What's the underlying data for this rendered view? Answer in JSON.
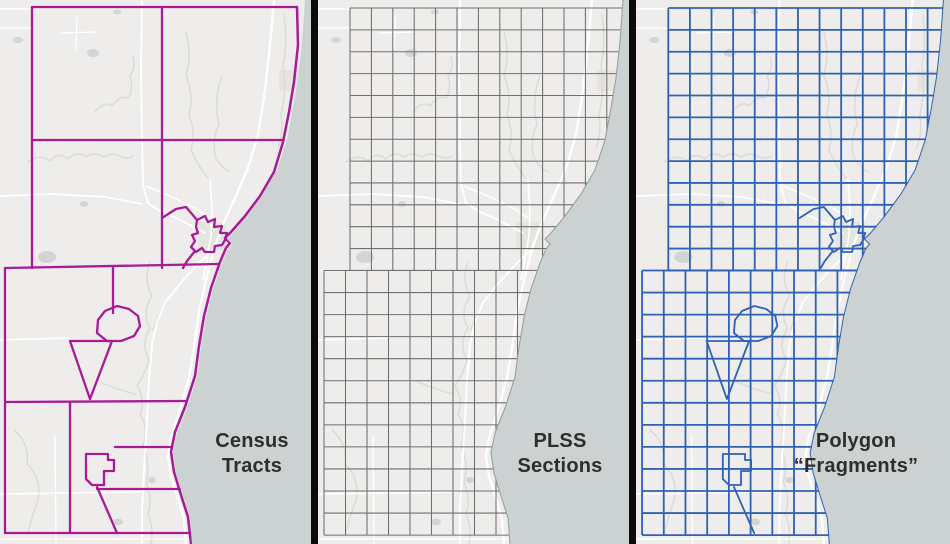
{
  "title": "Map comparison: Census Tracts vs PLSS Sections vs Polygon Fragments",
  "panels": [
    {
      "id": "census",
      "label_line1": "Census",
      "label_line2": "Tracts",
      "layer": "tracts",
      "accent": "#a81b96"
    },
    {
      "id": "plss",
      "label_line1": "PLSS",
      "label_line2": "Sections",
      "layer": "grid",
      "accent": "#6f6f6f"
    },
    {
      "id": "fragments",
      "label_line1": "Polygon",
      "label_line2": "“Fragments”",
      "layer": "fragments",
      "accent": "#2f62b4"
    }
  ],
  "colors": {
    "land": "#eeedeb",
    "lake": "#ccd1d1",
    "road": "#ffffff",
    "stream": "#dcdbd7",
    "pond": "#d2d5d4",
    "patch": "#e5e4df",
    "coast_gray": "#9aa0a0",
    "divider": "#0b0b0b",
    "label_text": "#2e2e2e"
  },
  "map": {
    "coast_points": [
      [
        305,
        0
      ],
      [
        302,
        42
      ],
      [
        298,
        78
      ],
      [
        293,
        108
      ],
      [
        287,
        140
      ],
      [
        277,
        170
      ],
      [
        263,
        194
      ],
      [
        247,
        216
      ],
      [
        233,
        233
      ],
      [
        227,
        239
      ],
      [
        232,
        244
      ],
      [
        228,
        249
      ],
      [
        222,
        263
      ],
      [
        213,
        289
      ],
      [
        206,
        317
      ],
      [
        201,
        347
      ],
      [
        197,
        377
      ],
      [
        187,
        408
      ],
      [
        177,
        433
      ],
      [
        173,
        453
      ],
      [
        176,
        473
      ],
      [
        183,
        496
      ],
      [
        190,
        518
      ],
      [
        192,
        544
      ]
    ],
    "tract_coast": "M297,7 L298,45 L294,82 L289,112 L283,142 L274,172 L260,196 L245,216 L231,232 L225,238 L230,243 L226,248 L220,262 L211,288 L204,316 L199,346 L195,376 L185,407 L175,432 L171,452 L174,472 L181,495 L188,517 L191,544",
    "tract_main": [
      "M32,7 L297,7",
      "M32,7 L32,268",
      "M162,7 L162,268",
      "M32,140 L283,140",
      "M5,268 L219,264",
      "M5,268 L5,533",
      "M5,533 L190,533",
      "M113,268 L113,313",
      "M70,402 L70,533",
      "M5,402 L187,401",
      "M115,447 L172,447",
      "M97,489 L183,489"
    ],
    "tract_extras": [
      "M162,218 L176,209 L186,207 L197,220",
      "M197,220 L205,216 L208,222 L215,219 L214,227 L222,226 L220,233 L227,233 L225,240 L222,245 L215,246 L214,252 L205,252 L202,248 L196,252 L191,247 L195,241 L192,235 L198,233 L196,227 Z",
      "M195,251 L187,261 L183,268",
      "M98,320 L105,311 L117,306 L129,309 L138,316 L140,326 L134,336 L121,341 L107,341 L97,333 Z",
      "M70,341 L112,341 L90,399 Z",
      "M86,454 L108,454 L108,460 L114,460 L114,471 L104,471 L104,485 L92,485 L86,479 Z",
      "M97,487 L117,533"
    ],
    "grid_townships": [
      {
        "vx0": 32,
        "vdx": 21.4,
        "vcount": 13,
        "vy1": 8,
        "vy2": 270.5,
        "hy0": 8,
        "hdy": 21.87,
        "hcount": 13,
        "hx1": 32,
        "hx2": 308
      },
      {
        "vx0": 6,
        "vdx": 21.5,
        "vcount": 11,
        "vy1": 270.5,
        "vy2": 535,
        "hy0": 270.5,
        "hdy": 22.05,
        "hcount": 13,
        "hx1": 6,
        "hx2": 308
      }
    ],
    "roads": [
      {
        "d": "M274,0 L270,45 L265,90 L258,135 L248,168 L235,198 L224,222 L215,246 L206,280 L199,312 L194,348 L189,378 L180,410 L171,438 L168,456 L171,476 L178,498 L184,519 L186,544",
        "w": 2.4
      },
      {
        "d": "M142,0 L141,70 L142,140 L143,185 L148,203 L160,211 L176,218 L192,226 L205,233",
        "w": 1.9
      },
      {
        "d": "M0,196 L55,194 L105,197 L142,204",
        "w": 1.7
      },
      {
        "d": "M210,180 L212,208 L211,236 L207,258 L203,280",
        "w": 1.7
      },
      {
        "d": "M213,250 L196,266 L178,286 L165,303 L157,322 L152,345 L149,380 L147,420 L144,470 L142,510 L142,544",
        "w": 1.9
      },
      {
        "d": "M60,33 L96,32",
        "w": 1.3
      },
      {
        "d": "M77,17 L76,49",
        "w": 1.3
      },
      {
        "d": "M0,28 L33,28",
        "w": 1.3
      },
      {
        "d": "M0,9 L32,9",
        "w": 1.2
      },
      {
        "d": "M0,340 L70,338",
        "w": 1.5
      },
      {
        "d": "M0,494 L140,492",
        "w": 1.5
      },
      {
        "d": "M55,436 L56,544",
        "w": 1.3
      },
      {
        "d": "M146,186 L170,196 L195,208 L210,218",
        "w": 1.5
      },
      {
        "d": "M0,539 L192,539",
        "w": 1.2
      }
    ],
    "streams": [
      "M95,112 Q105,100 112,106 Q120,95 128,98 Q134,88 130,76 Q136,68 133,57",
      "M28,162 Q40,153 50,161 Q58,151 68,159 Q76,150 86,157 Q94,151 104,157 Q112,152 120,156 Q128,160 134,156",
      "M186,32 Q192,55 186,75 Q194,95 189,115 Q196,132 191,150 Q198,166 208,178",
      "M222,76 Q213,100 219,124 Q211,142 216,158 Q222,168 230,172",
      "M150,262 Q143,280 152,296 Q141,312 150,328 Q140,344 149,360 Q145,374 137,386 Q146,400 140,414 Q149,428 143,446 Q151,464 146,482 Q153,498 148,514 Q154,528 151,544",
      "M168,300 Q158,314 153,330",
      "M100,382 Q118,390 135,394",
      "M14,430 Q30,444 27,464 Q42,478 38,500 Q32,516 28,532",
      "M284,15 Q288,40 283,65 Q287,90 281,115 Q284,132 278,148"
    ],
    "ponds": [
      [
        18,
        40,
        5,
        3
      ],
      [
        117,
        12,
        4,
        2.5
      ],
      [
        93,
        53,
        6,
        4
      ],
      [
        47,
        257,
        9,
        6
      ],
      [
        84,
        204,
        4,
        3
      ],
      [
        118,
        522,
        5,
        3.5
      ],
      [
        152,
        480,
        4,
        3
      ]
    ],
    "patches": [
      [
        279,
        70,
        23,
        21
      ],
      [
        198,
        222,
        28,
        28
      ]
    ]
  }
}
